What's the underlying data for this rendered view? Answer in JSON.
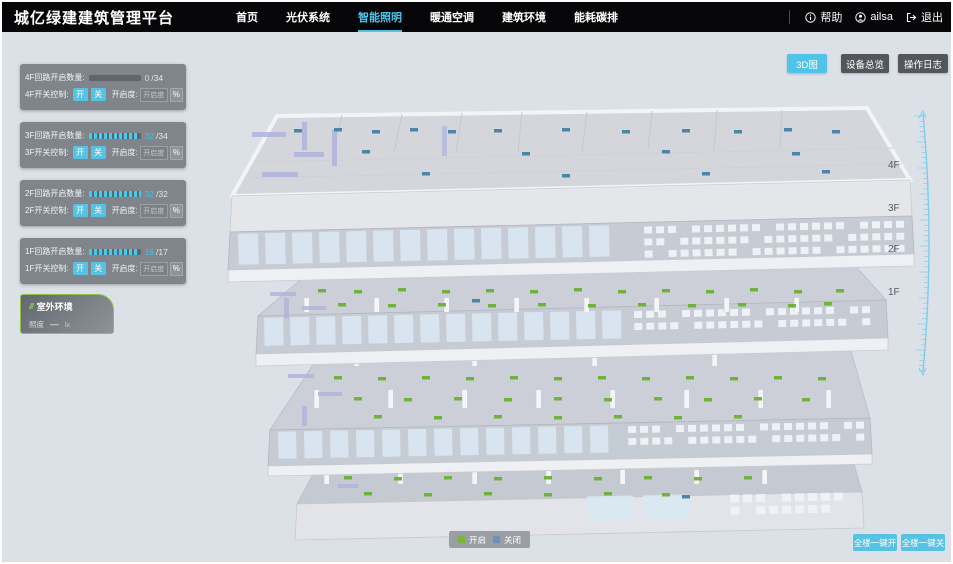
{
  "header": {
    "title": "城亿绿建建筑管理平台",
    "nav": [
      {
        "label": "首页",
        "active": false
      },
      {
        "label": "光伏系统",
        "active": false
      },
      {
        "label": "智能照明",
        "active": true
      },
      {
        "label": "暖通空调",
        "active": false
      },
      {
        "label": "建筑环境",
        "active": false
      },
      {
        "label": "能耗碳排",
        "active": false
      }
    ],
    "help_label": "帮助",
    "user_name": "ailsa",
    "logout_label": "退出"
  },
  "floor_panels": [
    {
      "count_label": "4F回路开启数量:",
      "value": "0",
      "total": "/34",
      "pct": 0,
      "value_color": "#d6dadd",
      "switch_label": "4F开关控制:",
      "on_label": "开",
      "off_label": "关",
      "dim_label": "开启度:",
      "dim_placeholder": "开启度",
      "unit_label": "%"
    },
    {
      "count_label": "3F回路开启数量:",
      "value": "32",
      "total": "/34",
      "pct": 94,
      "value_color": "#3fc6e8",
      "switch_label": "3F开关控制:",
      "on_label": "开",
      "off_label": "关",
      "dim_label": "开启度:",
      "dim_placeholder": "开启度",
      "unit_label": "%"
    },
    {
      "count_label": "2F回路开启数量:",
      "value": "32",
      "total": "/32",
      "pct": 100,
      "value_color": "#3fc6e8",
      "switch_label": "2F开关控制:",
      "on_label": "开",
      "off_label": "关",
      "dim_label": "开启度:",
      "dim_placeholder": "开启度",
      "unit_label": "%"
    },
    {
      "count_label": "1F回路开启数量:",
      "value": "16",
      "total": "/17",
      "pct": 94,
      "value_color": "#3fc6e8",
      "switch_label": "1F开关控制:",
      "on_label": "开",
      "off_label": "关",
      "dim_label": "开启度:",
      "dim_placeholder": "开启度",
      "unit_label": "%"
    }
  ],
  "outdoor": {
    "title": "室外环境",
    "metric_label": "照度",
    "metric_value": "—",
    "metric_unit": "lx"
  },
  "view_buttons": [
    {
      "label": "3D图",
      "active": true
    },
    {
      "label": "设备总览",
      "active": false
    },
    {
      "label": "操作日志",
      "active": false
    }
  ],
  "floor_scale": {
    "labels": [
      "4F",
      "3F",
      "2F",
      "1F"
    ],
    "label_y": [
      166,
      209,
      250,
      293
    ]
  },
  "legend": [
    {
      "label": "开启",
      "color": "#7cb342"
    },
    {
      "label": "关闭",
      "color": "#7191b4"
    }
  ],
  "bottom_actions": [
    {
      "label": "全楼一键开"
    },
    {
      "label": "全楼一键关"
    }
  ],
  "colors": {
    "accent": "#4fc3e8",
    "light_on": "#6fb33c",
    "light_off": "#4a86a8",
    "ruler": "#7ccdeb"
  },
  "building": {
    "markers": {
      "f4_off": [
        [
          292,
          127
        ],
        [
          332,
          126
        ],
        [
          370,
          128
        ],
        [
          408,
          126
        ],
        [
          446,
          128
        ],
        [
          492,
          127
        ],
        [
          560,
          126
        ],
        [
          620,
          128
        ],
        [
          680,
          127
        ],
        [
          732,
          128
        ],
        [
          782,
          126
        ],
        [
          830,
          128
        ],
        [
          360,
          148
        ],
        [
          520,
          150
        ],
        [
          660,
          148
        ],
        [
          790,
          150
        ],
        [
          420,
          170
        ],
        [
          560,
          172
        ],
        [
          700,
          170
        ],
        [
          820,
          168
        ]
      ],
      "f3_on": [
        [
          316,
          287
        ],
        [
          352,
          288
        ],
        [
          396,
          286
        ],
        [
          440,
          288
        ],
        [
          484,
          287
        ],
        [
          528,
          288
        ],
        [
          572,
          286
        ],
        [
          616,
          288
        ],
        [
          660,
          287
        ],
        [
          704,
          288
        ],
        [
          748,
          286
        ],
        [
          792,
          288
        ],
        [
          834,
          287
        ],
        [
          336,
          301
        ],
        [
          386,
          302
        ],
        [
          436,
          301
        ],
        [
          486,
          302
        ],
        [
          536,
          301
        ],
        [
          586,
          302
        ],
        [
          636,
          301
        ],
        [
          686,
          302
        ],
        [
          736,
          301
        ],
        [
          786,
          302
        ],
        [
          822,
          300
        ]
      ],
      "f3_off": [
        [
          470,
          297
        ]
      ],
      "f2_on": [
        [
          332,
          374
        ],
        [
          376,
          375
        ],
        [
          420,
          374
        ],
        [
          464,
          375
        ],
        [
          508,
          374
        ],
        [
          552,
          375
        ],
        [
          596,
          374
        ],
        [
          640,
          375
        ],
        [
          684,
          374
        ],
        [
          728,
          375
        ],
        [
          772,
          374
        ],
        [
          816,
          375
        ],
        [
          352,
          395
        ],
        [
          402,
          396
        ],
        [
          452,
          395
        ],
        [
          502,
          396
        ],
        [
          552,
          395
        ],
        [
          602,
          396
        ],
        [
          652,
          395
        ],
        [
          702,
          396
        ],
        [
          752,
          395
        ],
        [
          800,
          396
        ],
        [
          372,
          413
        ],
        [
          432,
          414
        ],
        [
          492,
          413
        ],
        [
          552,
          414
        ],
        [
          612,
          413
        ],
        [
          672,
          414
        ],
        [
          732,
          413
        ]
      ],
      "f2_off": [],
      "f1_on": [
        [
          342,
          474
        ],
        [
          392,
          475
        ],
        [
          442,
          474
        ],
        [
          492,
          475
        ],
        [
          542,
          474
        ],
        [
          592,
          475
        ],
        [
          642,
          474
        ],
        [
          692,
          475
        ],
        [
          742,
          474
        ],
        [
          362,
          490
        ],
        [
          422,
          491
        ],
        [
          482,
          490
        ],
        [
          542,
          491
        ],
        [
          602,
          490
        ],
        [
          660,
          491
        ]
      ],
      "f1_off": [
        [
          680,
          493
        ]
      ]
    }
  }
}
